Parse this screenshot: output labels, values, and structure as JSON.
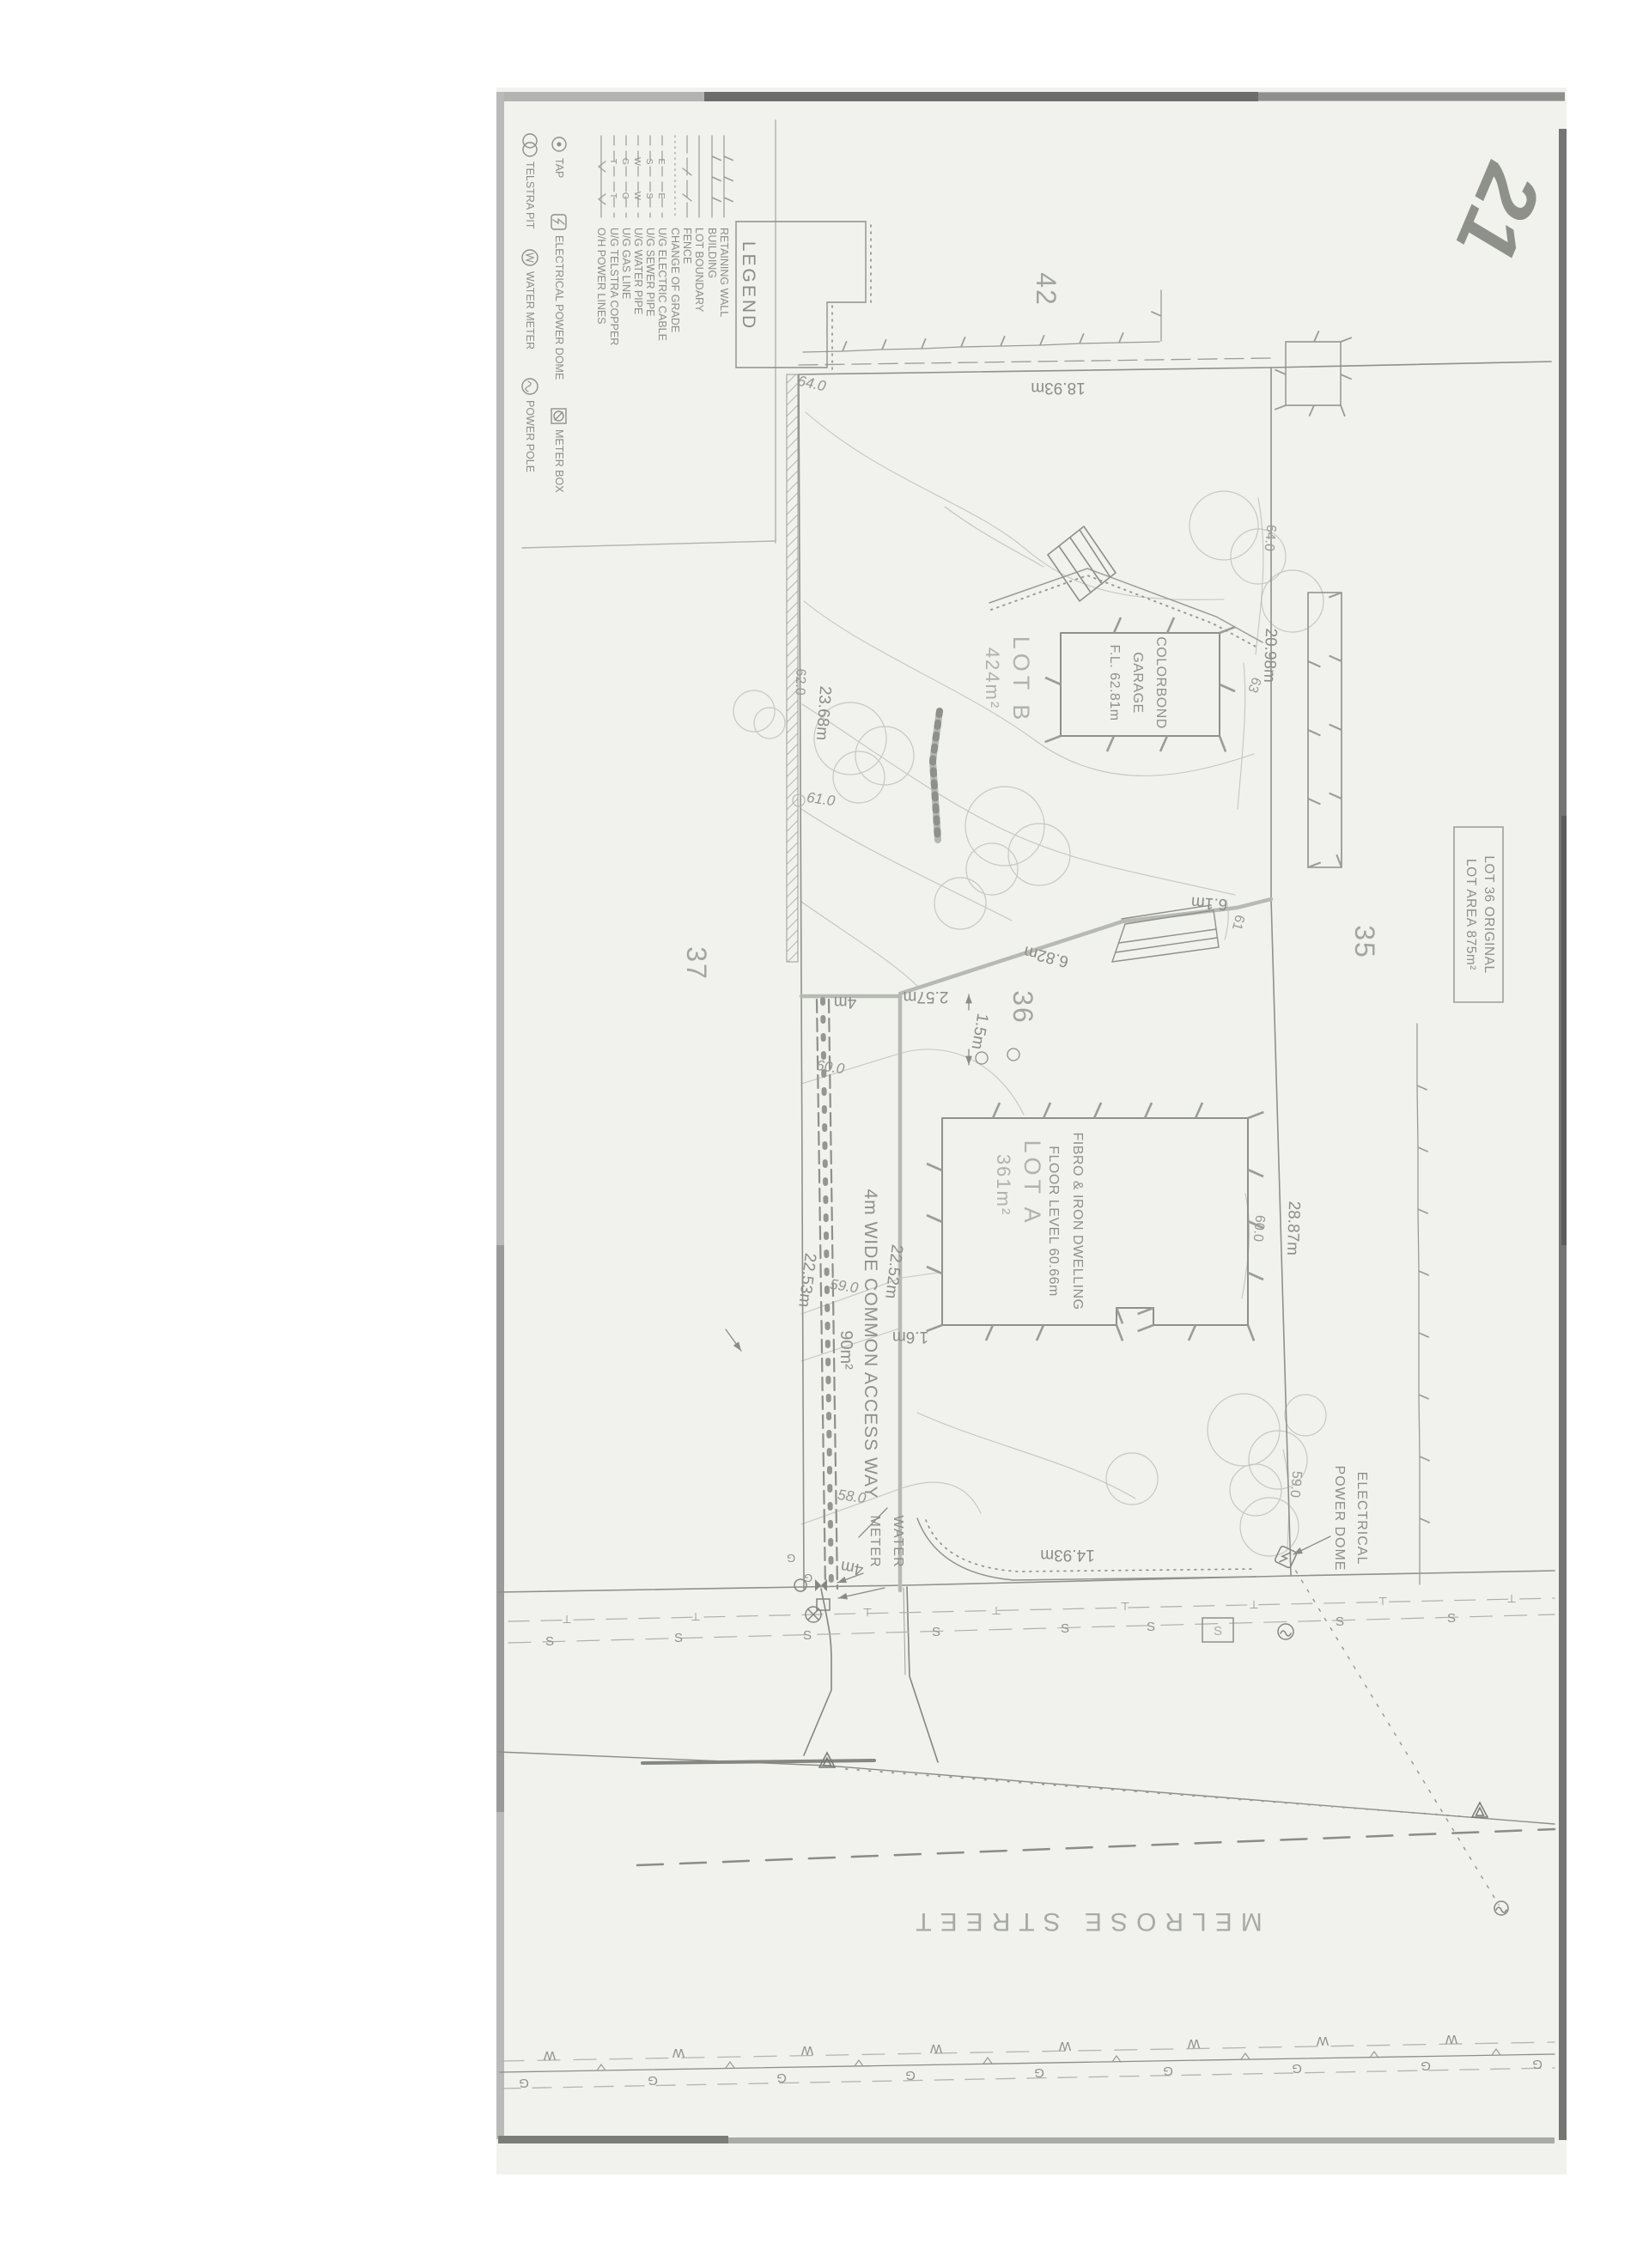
{
  "logo_text": "21",
  "legend": {
    "title": "LEGEND",
    "line_items": [
      {
        "label": "RETAINING WALL",
        "letter": ""
      },
      {
        "label": "BUILDING",
        "letter": ""
      },
      {
        "label": "LOT BOUNDARY",
        "letter": ""
      },
      {
        "label": "FENCE",
        "letter": ""
      },
      {
        "label": "CHANGE OF GRADE",
        "letter": ""
      },
      {
        "label": "U/G ELECTRIC CABLE",
        "letter": "E"
      },
      {
        "label": "U/G SEWER PIPE",
        "letter": "S"
      },
      {
        "label": "U/G WATER PIPE",
        "letter": "W"
      },
      {
        "label": "U/G GAS LINE",
        "letter": "G"
      },
      {
        "label": "U/G TELSTRA COPPER",
        "letter": "T"
      },
      {
        "label": "O/H POWER LINES",
        "letter": "v"
      }
    ],
    "symbol_items": [
      {
        "label": "TAP",
        "icon": "tap-icon"
      },
      {
        "label": "ELECTRICAL POWER DOME",
        "icon": "power-dome-icon"
      },
      {
        "label": "METER BOX",
        "icon": "meter-box-icon"
      },
      {
        "label": "TELSTRA PIT",
        "icon": "telstra-pit-icon"
      },
      {
        "label": "WATER METER",
        "icon": "water-meter-icon"
      },
      {
        "label": "POWER POLE",
        "icon": "power-pole-icon"
      }
    ]
  },
  "plan": {
    "street_name": "MELROSE STREET",
    "lot_numbers": {
      "n42": "42",
      "n37": "37",
      "n36": "36",
      "n35": "35"
    },
    "lot_a": {
      "name": "LOT A",
      "area": "361m²"
    },
    "lot_b": {
      "name": "LOT B",
      "area": "424m²"
    },
    "lot36_box": {
      "line1": "LOT 36 ORIGINAL",
      "line2": "LOT AREA 875m²"
    },
    "dwelling": {
      "line1": "FIBRO & IRON DWELLING",
      "line2": "FLOOR LEVEL 60.66m"
    },
    "garage": {
      "line1": "COLORBOND",
      "line2": "GARAGE",
      "line3": "F.L. 62.81m"
    },
    "access_way": {
      "title": "4m WIDE COMMON ACCESS WAY",
      "area": "90m²"
    },
    "dimensions": {
      "top": "18.93m",
      "lot_b_west": "23.68m",
      "lot_b_east": "20.98m",
      "jog_682": "6.82m",
      "jog_61": "6.1m",
      "jog_257": "2.57m",
      "jog_15": "1.5m",
      "gap_16": "1.6m",
      "aw_west_1": "22.53m",
      "aw_west_2": "22.52m",
      "lot_a_east": "28.87m",
      "lot_a_front": "14.93m",
      "aw_width_top": "4m",
      "aw_width_front": "4m"
    },
    "levels": {
      "l64_hand": "64.0",
      "l64": "64.0",
      "l63": "63",
      "l62": "62.0",
      "l61_0": "61.0",
      "l61": "61",
      "l60_w": "60.0",
      "l60_e": "60.0",
      "l59_w": "59.0",
      "l59_e": "59.0",
      "l58": "58.0"
    },
    "callouts": {
      "water_meter_1": "WATER",
      "water_meter_2": "METER",
      "power_dome_1": "ELECTRICAL",
      "power_dome_2": "POWER DOME"
    },
    "utilities": {
      "sewer": "S",
      "water": "W",
      "gas": "G",
      "telstra": "⊥"
    }
  }
}
